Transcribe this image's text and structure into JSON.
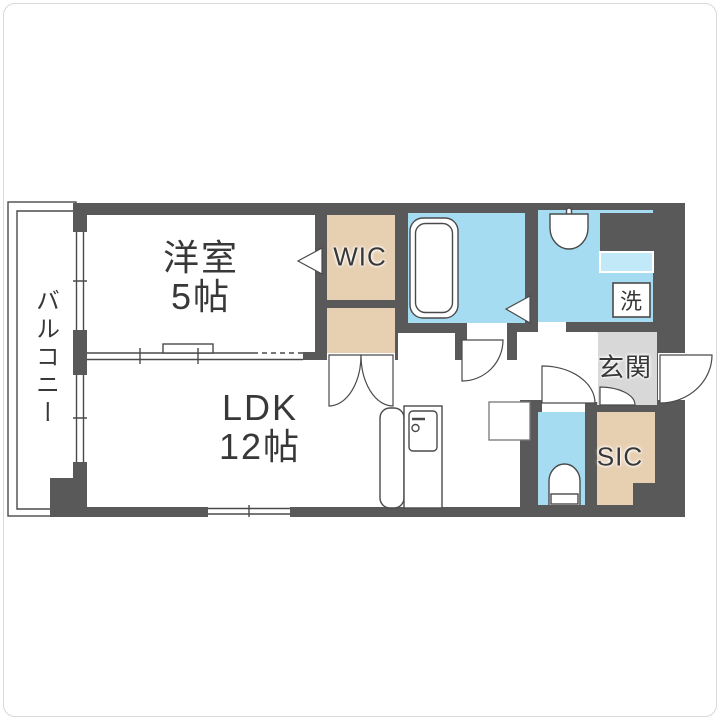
{
  "floorplan": {
    "balcony": {
      "label": "バルコニー"
    },
    "western_room": {
      "label": "洋室",
      "size": "5帖"
    },
    "wic": {
      "label": "WIC"
    },
    "ldk": {
      "label": "LDK",
      "size": "12帖"
    },
    "washer_space": {
      "label": "洗"
    },
    "entrance": {
      "label": "玄関"
    },
    "sic": {
      "label": "SIC"
    },
    "colors": {
      "wall": "#595959",
      "wet": "#a6dcf2",
      "storage": "#e7cfb1",
      "genkanFloor": "#d8d8d8",
      "counter": "#c2e9f8"
    }
  }
}
